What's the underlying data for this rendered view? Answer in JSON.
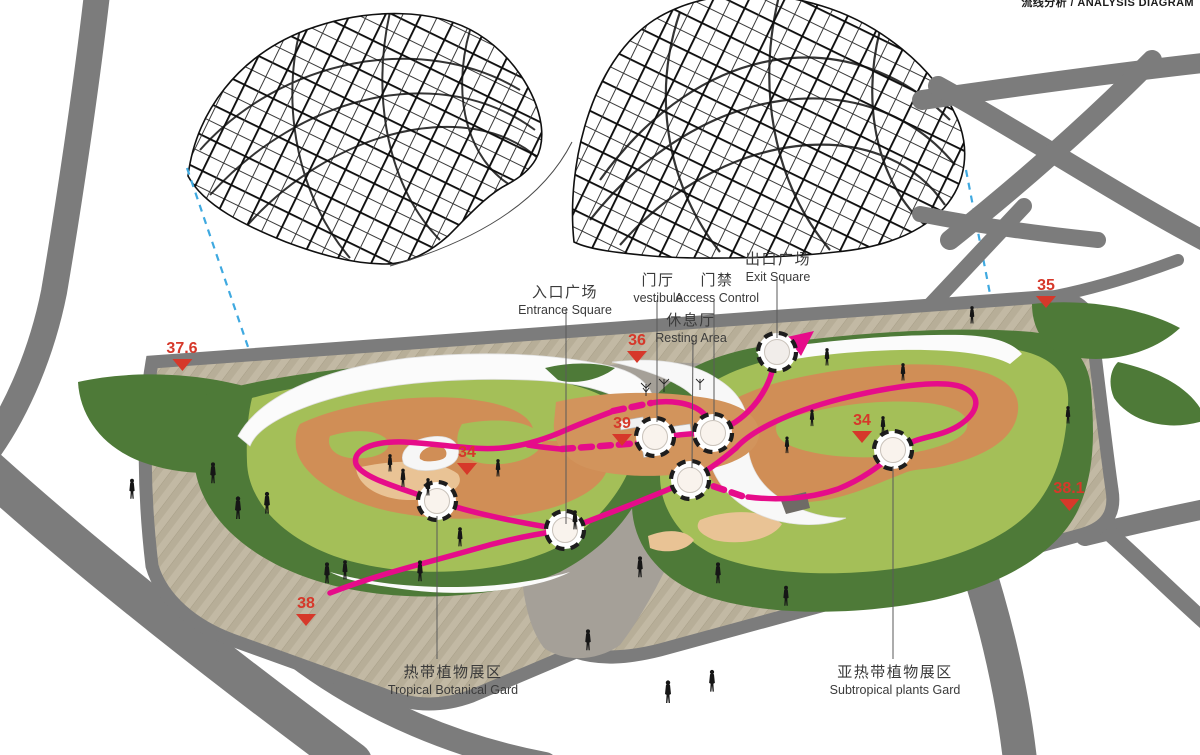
{
  "header": {
    "cropped_note": "流线分析 / ANALYSIS DIAGRAM"
  },
  "labels": {
    "entrance": {
      "zh": "入口广场",
      "en": "Entrance Square"
    },
    "vestibule": {
      "zh": "门厅",
      "en": "vestibule"
    },
    "access": {
      "zh": "门禁",
      "en": "Access Control"
    },
    "resting": {
      "zh": "休息厅",
      "en": "Resting Area"
    },
    "exit": {
      "zh": "出口广场",
      "en": "Exit Square"
    },
    "tropical": {
      "zh": "热带植物展区",
      "en": "Tropical Botanical Gard"
    },
    "subtropical": {
      "zh": "亚热带植物展区",
      "en": "Subtropical plants Gard"
    }
  },
  "elevations": [
    {
      "name": "spot-37-6",
      "value": "37.6"
    },
    {
      "name": "spot-36",
      "value": "36"
    },
    {
      "name": "spot-35",
      "value": "35"
    },
    {
      "name": "spot-39",
      "value": "39"
    },
    {
      "name": "spot-34-west",
      "value": "34"
    },
    {
      "name": "spot-34-east",
      "value": "34"
    },
    {
      "name": "spot-38",
      "value": "38"
    },
    {
      "name": "spot-38-1",
      "value": "38.1"
    }
  ],
  "colors": {
    "route_pink": "#e60c8a",
    "elevation_red": "#d6382a",
    "road_gray": "#7c7c7c",
    "lawn_dark_green": "#4e7a38",
    "lawn_bright_green": "#a4bf58",
    "garden_path_orange": "#d08e56",
    "plaza_tan": "#c2b9a4",
    "callout_blue": "#3fa9e0"
  }
}
